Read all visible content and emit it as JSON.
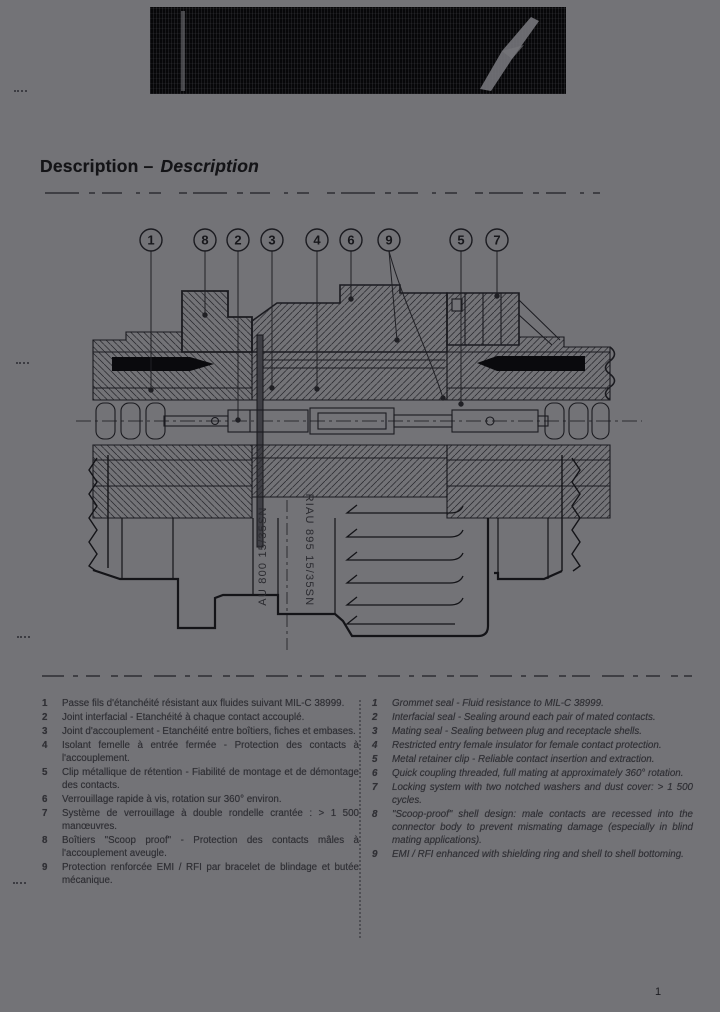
{
  "colors": {
    "page_background": "#737377",
    "ink": "#17171b",
    "band_background": "#070709",
    "legend_text": "#303035"
  },
  "heading": {
    "title": "Description",
    "separator": "–",
    "title_italic": "Description"
  },
  "diagram": {
    "callouts": [
      {
        "label": "1",
        "x": 151
      },
      {
        "label": "8",
        "x": 205
      },
      {
        "label": "2",
        "x": 238
      },
      {
        "label": "3",
        "x": 272
      },
      {
        "label": "4",
        "x": 317
      },
      {
        "label": "6",
        "x": 351
      },
      {
        "label": "9",
        "x": 389
      },
      {
        "label": "5",
        "x": 461
      },
      {
        "label": "7",
        "x": 497
      }
    ],
    "markings": {
      "left": "AU 800 15/35SN",
      "right": "RIAU 895 15/35SN"
    }
  },
  "legend_fr": {
    "items": [
      {
        "n": "1",
        "text": "Passe fils d'étanchéité résistant aux fluides suivant MIL-C 38999."
      },
      {
        "n": "2",
        "text": "Joint interfacial - Etanchéité à chaque contact accouplé."
      },
      {
        "n": "3",
        "text": "Joint d'accouplement - Etanchéité entre boîtiers, fiches et embases."
      },
      {
        "n": "4",
        "text": "Isolant femelle à entrée fermée - Protection des contacts à l'accouplement."
      },
      {
        "n": "5",
        "text": "Clip métallique de rétention - Fiabilité de montage et de démontage des contacts."
      },
      {
        "n": "6",
        "text": "Verrouillage rapide à vis, rotation sur 360° environ."
      },
      {
        "n": "7",
        "text": "Système de verrouillage à double rondelle crantée : > 1 500 manœuvres."
      },
      {
        "n": "8",
        "text": "Boîtiers \"Scoop proof\" - Protection des contacts mâles à l'accouplement aveugle."
      },
      {
        "n": "9",
        "text": "Protection renforcée EMI / RFI par bracelet de blindage et butée mécanique."
      }
    ]
  },
  "legend_en": {
    "items": [
      {
        "n": "1",
        "text": "Grommet seal - Fluid resistance to MIL-C 38999."
      },
      {
        "n": "2",
        "text": "Interfacial seal - Sealing around each pair of mated contacts."
      },
      {
        "n": "3",
        "text": "Mating seal - Sealing between plug and receptacle shells."
      },
      {
        "n": "4",
        "text": "Restricted entry female insulator for female contact protection."
      },
      {
        "n": "5",
        "text": "Metal retainer clip - Reliable contact insertion and extraction."
      },
      {
        "n": "6",
        "text": "Quick coupling threaded, full mating at approximately 360° rotation."
      },
      {
        "n": "7",
        "text": "Locking system with two notched washers and dust cover: > 1 500 cycles."
      },
      {
        "n": "8",
        "text": "\"Scoop-proof\" shell design: male contacts are recessed into the connector body to prevent mismating damage (especially in blind mating applications)."
      },
      {
        "n": "9",
        "text": "EMI / RFI enhanced with shielding ring and shell to shell bottoming."
      }
    ]
  },
  "footer": {
    "page_number": "1"
  }
}
